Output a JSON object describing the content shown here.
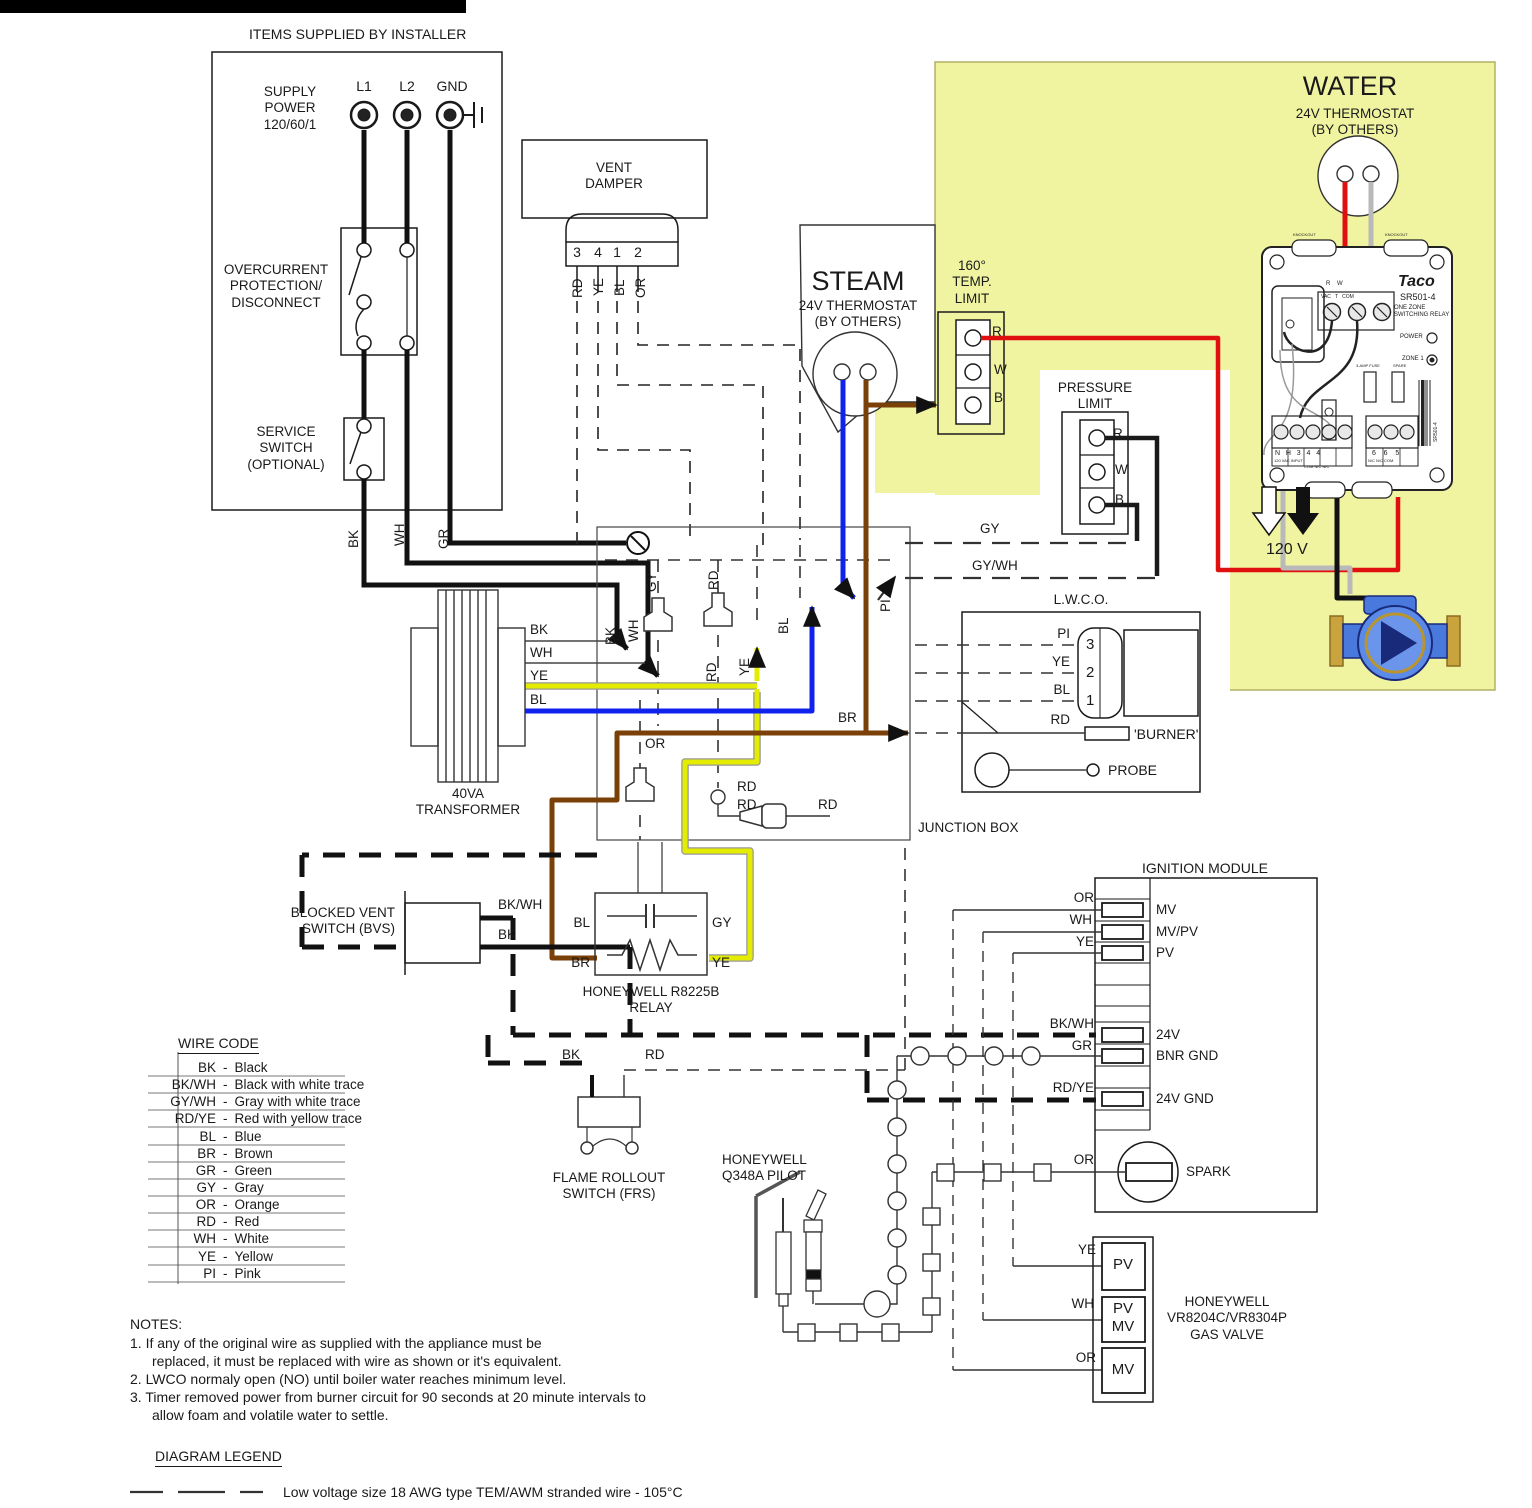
{
  "colors": {
    "highlight": "#f0f4a0",
    "wire_yellow": "#e4ec00",
    "wire_blue": "#1023ee",
    "wire_brown": "#7a4008",
    "wire_red": "#e01010",
    "wire_gray": "#b9b9b9"
  },
  "wl": {
    "bk": "BK",
    "wh": "WH",
    "gr": "GR",
    "gy": "GY",
    "rd": "RD",
    "ye": "YE",
    "bl": "BL",
    "or": "OR",
    "br": "BR",
    "pi": "PI",
    "bkwh": "BK/WH",
    "gywh": "GY/WH",
    "rdye": "RD/YE"
  },
  "installer": {
    "title": "ITEMS SUPPLIED BY INSTALLER",
    "supply": "SUPPLY\nPOWER\n120/60/1",
    "l1": "L1",
    "l2": "L2",
    "gnd": "GND",
    "overcurrent": "OVERCURRENT\nPROTECTION/\nDISCONNECT",
    "service": "SERVICE\nSWITCH\n(OPTIONAL)"
  },
  "vent": {
    "title": "VENT\nDAMPER",
    "p3": "3",
    "p4": "4",
    "p1": "1",
    "p2": "2"
  },
  "steam": {
    "title": "STEAM",
    "sub": "24V THERMOSTAT\n(BY OTHERS)"
  },
  "temp_limit": {
    "title": "160°\nTEMP.\nLIMIT",
    "r": "R",
    "w": "W",
    "b": "B"
  },
  "pressure_limit": {
    "title": "PRESSURE\nLIMIT",
    "r": "R",
    "w": "W",
    "b": "B"
  },
  "water": {
    "title": "WATER",
    "sub": "24V THERMOSTAT\n(BY OTHERS)",
    "volt": "120 V",
    "relay": {
      "brand": "Taco",
      "model": "SR501-4",
      "type": "ONE ZONE\nSWITCHING RELAY",
      "power": "POWER",
      "zone": "ZONE 1",
      "knockout": "KNOCKOUT",
      "row_rw": "R    W",
      "row_vac": "VAC   T   COM",
      "fuse": "3-AMP FUSE",
      "spare": "SPARE",
      "left_terms": "N   H   3   4   4",
      "left_sub": "120 VAC INPUT",
      "left_sub2": "COM N/C N/C",
      "right_terms": "6    6    5",
      "right_sub": "N/C N/C COM",
      "side_model": "SR501-4"
    }
  },
  "junction": {
    "label": "JUNCTION BOX"
  },
  "transformer": {
    "title": "40VA\nTRANSFORMER"
  },
  "lwco": {
    "title": "L.W.C.O.",
    "n3": "3",
    "n2": "2",
    "n1": "1",
    "burner": "'BURNER'",
    "probe": "PROBE"
  },
  "bvs": {
    "title": "BLOCKED VENT\nSWITCH (BVS)"
  },
  "relay8225": {
    "title": "HONEYWELL R8225B\nRELAY"
  },
  "wire_code": {
    "title": "WIRE CODE",
    "sep": "-",
    "items": [
      {
        "code": "BK",
        "name": "Black"
      },
      {
        "code": "BK/WH",
        "name": "Black with white trace"
      },
      {
        "code": "GY/WH",
        "name": "Gray with white trace"
      },
      {
        "code": "RD/YE",
        "name": "Red with yellow trace"
      },
      {
        "code": "BL",
        "name": "Blue"
      },
      {
        "code": "BR",
        "name": "Brown"
      },
      {
        "code": "GR",
        "name": "Green"
      },
      {
        "code": "GY",
        "name": "Gray"
      },
      {
        "code": "OR",
        "name": "Orange"
      },
      {
        "code": "RD",
        "name": "Red"
      },
      {
        "code": "WH",
        "name": "White"
      },
      {
        "code": "YE",
        "name": "Yellow"
      },
      {
        "code": "PI",
        "name": "Pink"
      }
    ]
  },
  "frs": {
    "title": "FLAME ROLLOUT\nSWITCH (FRS)"
  },
  "pilot": {
    "title": "HONEYWELL\nQ348A PILOT"
  },
  "ignition": {
    "title": "IGNITION MODULE",
    "mv": "MV",
    "mvpv": "MV/PV",
    "pv": "PV",
    "v24": "24V",
    "bnr": "BNR GND",
    "gnd24": "24V GND",
    "spark": "SPARK"
  },
  "gas_valve": {
    "title": "HONEYWELL\nVR8204C/VR8304P\nGAS VALVE",
    "pv": "PV",
    "pvmv": "PV\nMV",
    "mv": "MV"
  },
  "notes": {
    "title": "NOTES:",
    "l1": "1. If any of the original wire as supplied with the appliance must be",
    "l2": "replaced, it must be replaced with wire as shown or it's equivalent.",
    "l3": "2. LWCO normaly open (NO) until boiler water reaches minimum level.",
    "l4": "3. Timer removed power from burner circuit for 90 seconds at 20 minute intervals to",
    "l5": "allow foam and volatile water to settle."
  },
  "legend": {
    "title": "DIAGRAM LEGEND",
    "low_voltage": "Low voltage size 18 AWG type TEM/AWM stranded wire - 105°C"
  }
}
